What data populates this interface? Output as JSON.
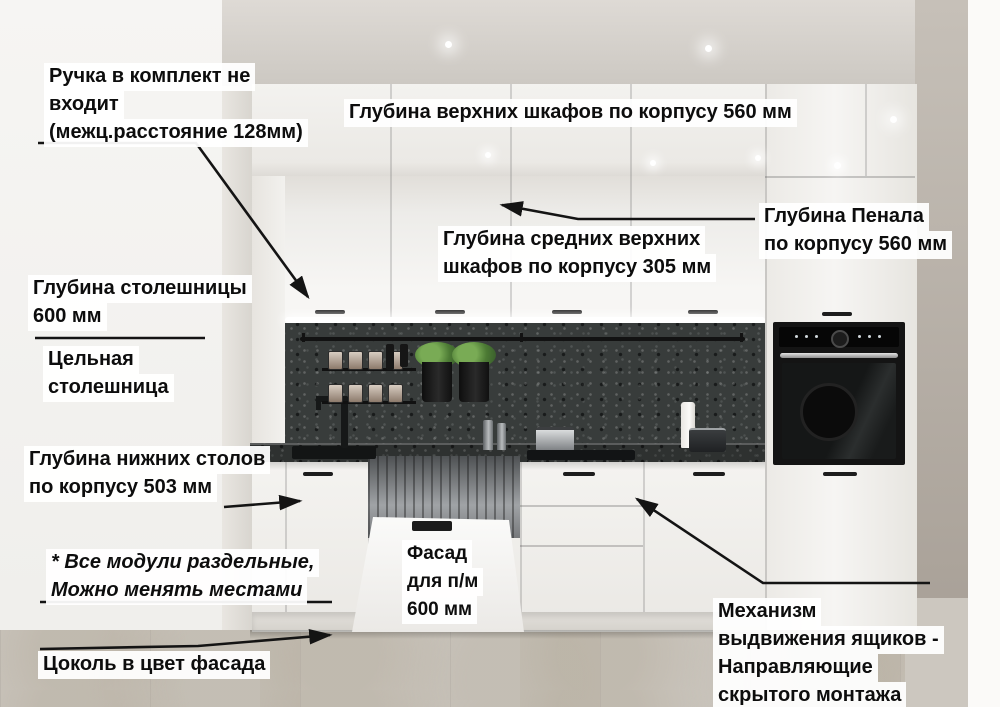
{
  "annotations": {
    "handle_note": {
      "lines": [
        "Ручка в комплект не",
        "входит",
        "(межц.расстояние 128мм)"
      ]
    },
    "upper_cabinet_depth": {
      "lines": [
        "Глубина верхних шкафов по корпусу 560 мм"
      ]
    },
    "mid_upper_depth": {
      "lines": [
        "Глубина средних верхних",
        "шкафов по корпусу 305 мм"
      ]
    },
    "tall_cabinet_depth": {
      "lines": [
        "Глубина Пенала",
        "по корпусу 560 мм"
      ]
    },
    "countertop_depth": {
      "lines": [
        "Глубина столешницы",
        "600 мм"
      ]
    },
    "solid_countertop": {
      "lines": [
        "Цельная",
        "столешница"
      ]
    },
    "base_cabinet_depth": {
      "lines": [
        "Глубина нижних столов",
        "по корпусу 503 мм"
      ]
    },
    "modules_note": {
      "lines": [
        "* Все модули раздельные,",
        "Можно менять местами"
      ]
    },
    "plinth_note": {
      "lines": [
        "Цоколь в цвет фасада"
      ]
    },
    "dishwasher_facade": {
      "lines": [
        "Фасад",
        "для п/м",
        "600 мм"
      ]
    },
    "drawer_mechanism": {
      "lines": [
        "Механизм",
        "выдвижения ящиков -",
        "Направляющие",
        "скрытого монтажа"
      ]
    }
  },
  "palette": {
    "annotation_text": "#0d0d0d",
    "annotation_highlight": "#ffffff",
    "cabinet_white": "#f3f2ef",
    "stone_dark": "#383c3b",
    "oven_black": "#141414",
    "floor_tile": "#cac5bd",
    "plant_green": "#4c7a34"
  }
}
